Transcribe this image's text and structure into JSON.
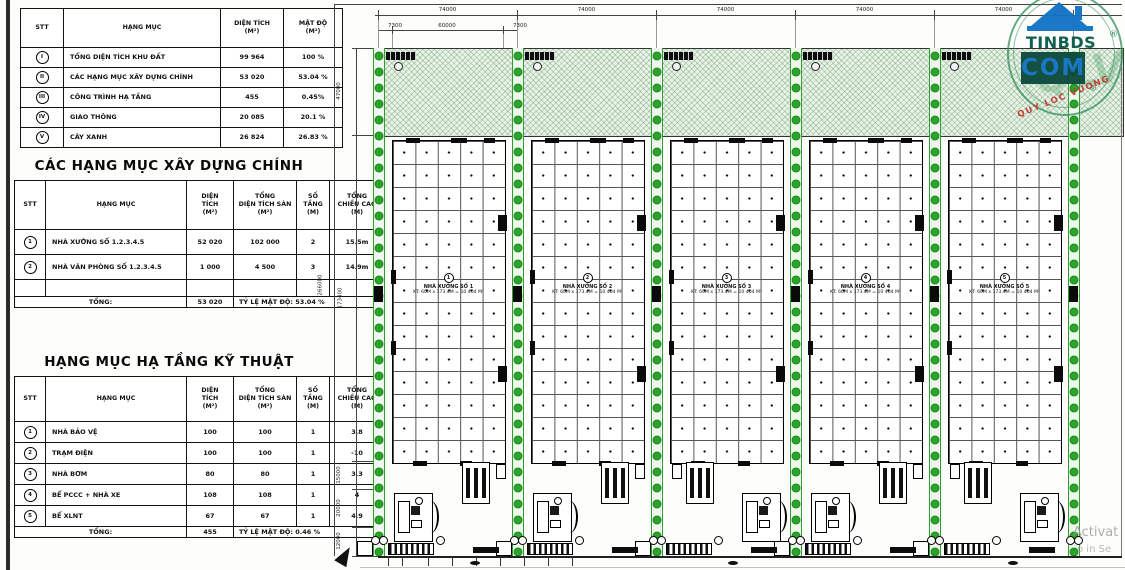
{
  "tables": {
    "summary": {
      "headers": [
        "STT",
        "HẠNG MỤC",
        "DIỆN TÍCH\n(M²)",
        "MẬT ĐỘ\n(M²)"
      ],
      "rows": [
        [
          "I",
          "TỔNG DIỆN TÍCH KHU ĐẤT",
          "99 964",
          "100 %"
        ],
        [
          "II",
          "CÁC HẠNG MỤC XÂY DỰNG CHÍNH",
          "53 020",
          "53.04 %"
        ],
        [
          "III",
          "CÔNG TRÌNH HẠ TẦNG",
          "455",
          "0.45%"
        ],
        [
          "IV",
          "GIAO THÔNG",
          "20 085",
          "20.1 %"
        ],
        [
          "V",
          "CÂY XANH",
          "26 824",
          "26.83 %"
        ]
      ]
    },
    "main": {
      "title": "CÁC HẠNG MỤC XÂY DỰNG CHÍNH",
      "headers": [
        "STT",
        "HẠNG MỤC",
        "DIỆN\nTÍCH\n(M²)",
        "TỔNG\nDIỆN TÍCH SÀN\n(M²)",
        "SỐ\nTẦNG\n(M)",
        "TỔNG\nCHIỀU CAO\n(M)"
      ],
      "rows": [
        [
          "1",
          "NHÀ XƯỞNG SỐ 1.2.3.4.5",
          "52 020",
          "102 000",
          "2",
          "15.5m"
        ],
        [
          "2",
          "NHÀ VĂN PHÒNG SỐ 1.2.3.4.5",
          "1 000",
          "4 500",
          "3",
          "14.9m"
        ],
        [
          "",
          "",
          "",
          "",
          "",
          ""
        ]
      ],
      "total": {
        "label": "TỔNG:",
        "area": "53 020",
        "note": "TỶ LỆ MẬT ĐỘ: 53.04 %"
      }
    },
    "infra": {
      "title": "HẠNG MỤC HẠ TẦNG KỸ THUẬT",
      "headers": [
        "STT",
        "HẠNG MỤC",
        "DIỆN\nTÍCH\n(M²)",
        "TỔNG\nDIỆN TÍCH SÀN\n(M²)",
        "SỐ\nTẦNG\n(M)",
        "TỔNG\nCHIỀU CAO\n(M)"
      ],
      "rows": [
        [
          "1",
          "NHÀ BẢO VỆ",
          "100",
          "100",
          "1",
          "3.8"
        ],
        [
          "2",
          "TRẠM ĐIỆN",
          "100",
          "100",
          "1",
          "-10"
        ],
        [
          "3",
          "NHÀ BƠM",
          "80",
          "80",
          "1",
          "3.3"
        ],
        [
          "4",
          "BỂ PCCC + NHÀ XE",
          "108",
          "108",
          "1",
          "4"
        ],
        [
          "5",
          "BỂ XLNT",
          "67",
          "67",
          "1",
          "4.9"
        ]
      ],
      "total": {
        "label": "TỔNG:",
        "area": "455",
        "note": "TỶ LỆ MẬT ĐỘ: 0.46 %"
      }
    }
  },
  "plan": {
    "top_dims": [
      "74000",
      "74000",
      "74000",
      "74000",
      "74000"
    ],
    "sub_dims": [
      "7300",
      "60000",
      "7300"
    ],
    "left_overall": "266000",
    "left_dims": [
      "47000",
      "173400",
      "15000",
      "20000",
      "12000"
    ],
    "buildings": [
      {
        "no": "1",
        "name": "NHÀ XƯỞNG SỐ 1",
        "size": "KT: 60M x 173.4M = 10 404 M²"
      },
      {
        "no": "2",
        "name": "NHÀ XƯỞNG SỐ 2",
        "size": "KT: 60M x 173.4M = 10 404 M²"
      },
      {
        "no": "3",
        "name": "NHÀ XƯỞNG SỐ 3",
        "size": "KT: 60M x 173.4M = 10 404 M²"
      },
      {
        "no": "4",
        "name": "NHÀ XƯỞNG SỐ 4",
        "size": "KT: 60M x 173.4M = 10 404 M²"
      },
      {
        "no": "5",
        "name": "NHÀ XƯỞNG SỐ 5",
        "size": "KT: 60M x 173.4M = 10 404 M²"
      }
    ]
  },
  "watermark": {
    "brand": "TINBDS",
    "tld": "COM",
    "ghost": "QLV",
    "slogan": "QUY LOC VUONG",
    "reg": "®"
  },
  "activation": {
    "line1": "Activat",
    "line2": "o in Se"
  },
  "colors": {
    "tree_green": "#2aa42a",
    "band_green": "#e9f3e9",
    "logo_blue": "#1273c4",
    "logo_teal": "#0d4b3e",
    "slogan_red": "#c0392b"
  }
}
